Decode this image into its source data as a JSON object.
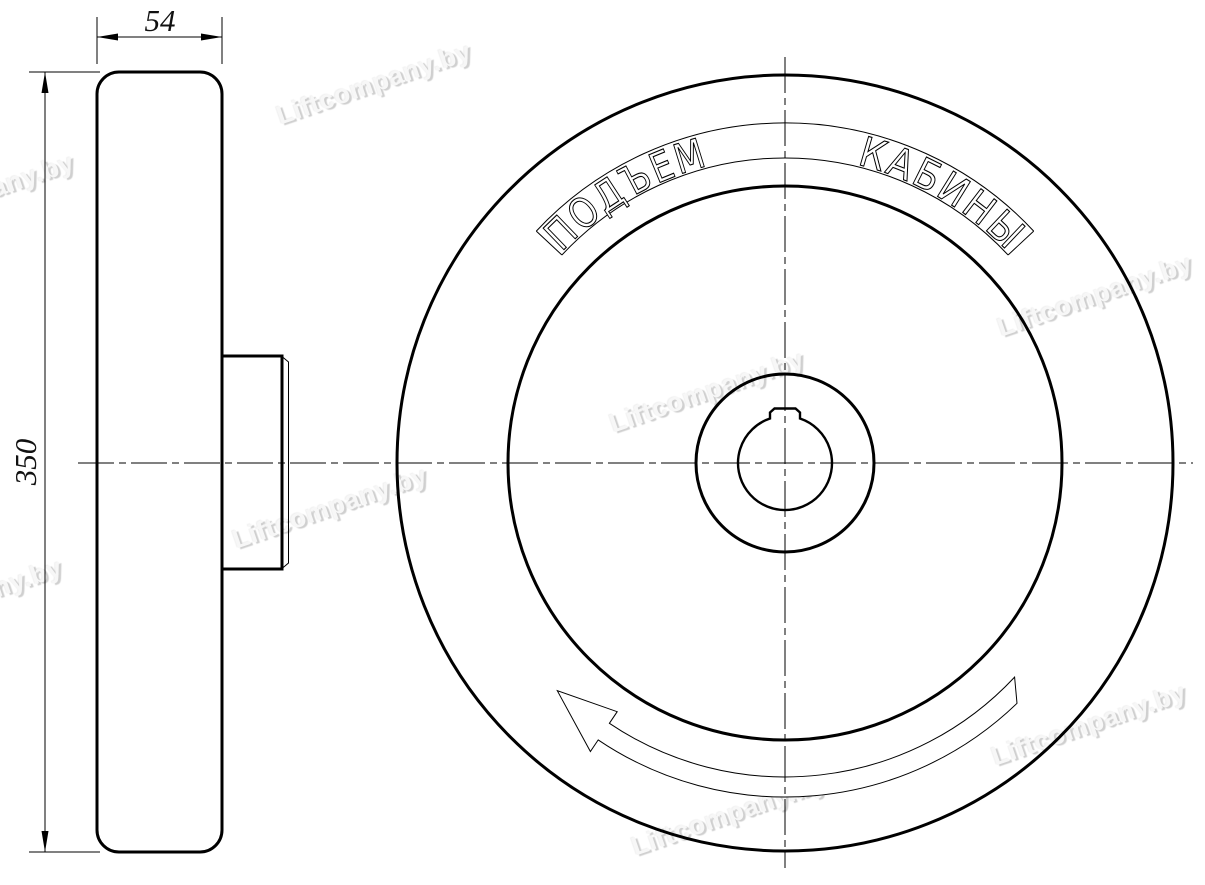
{
  "drawing": {
    "type": "technical-drawing",
    "subject": "lift-handwheel-two-views",
    "colors": {
      "line": "#000000",
      "background": "#ffffff",
      "watermark": "#f7f7f7",
      "watermark_shadow": "#cfcfcf"
    },
    "engraving": {
      "word1": "ПОДЪЕМ",
      "word2": "КАБИНЫ"
    },
    "dimensions": {
      "rim_width": "54",
      "outer_diameter": "350"
    },
    "watermark_text": "Liftcompany.by"
  }
}
